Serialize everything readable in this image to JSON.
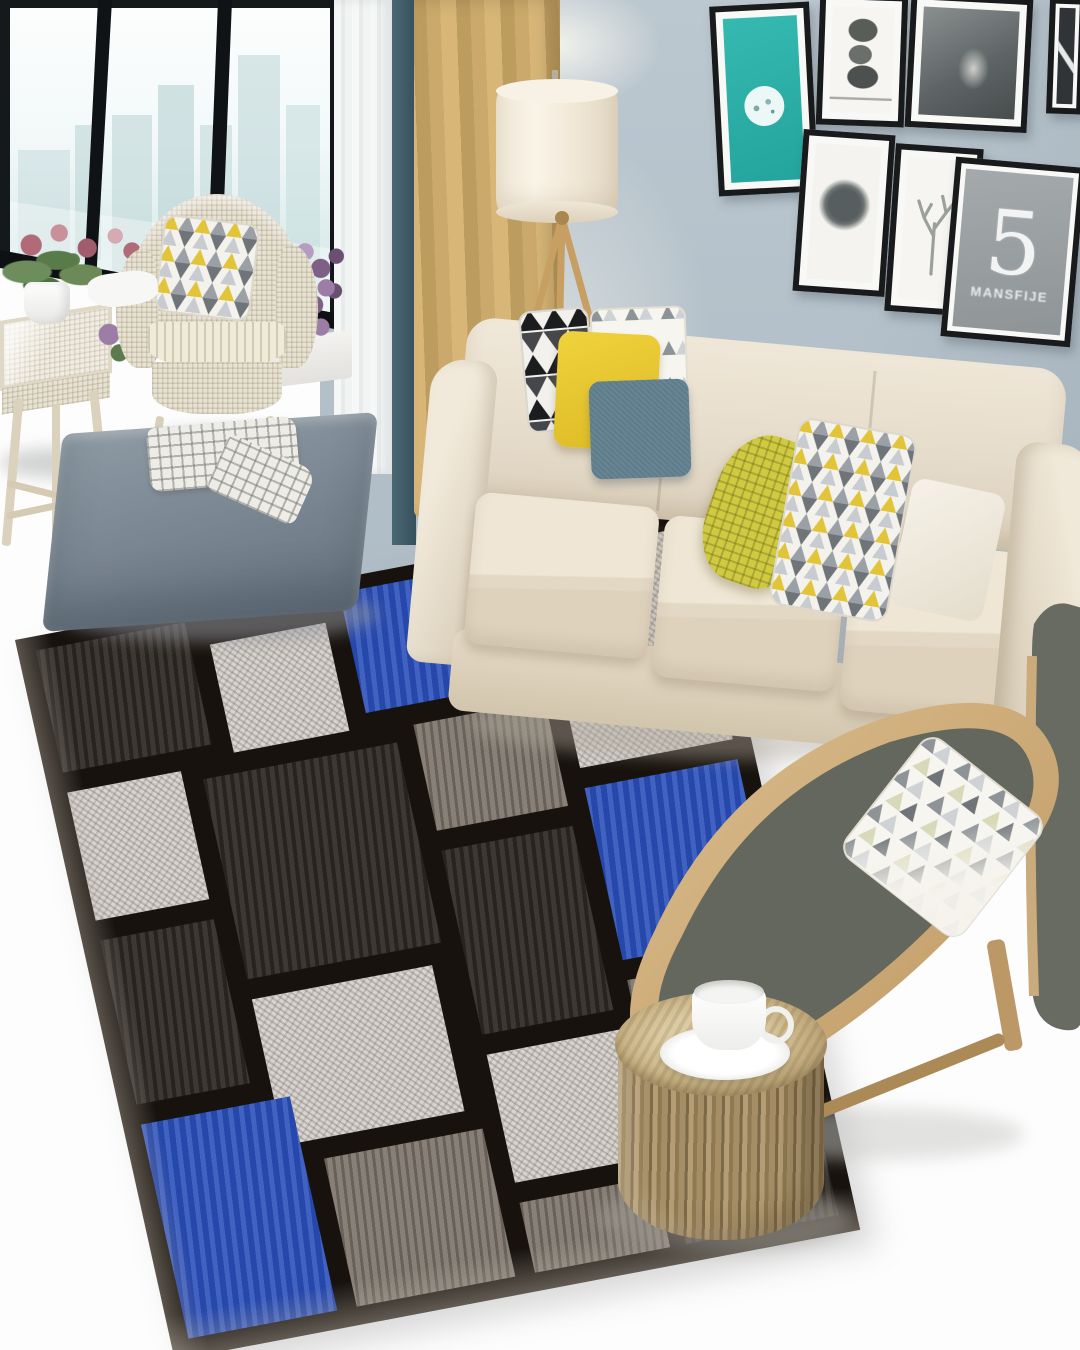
{
  "scene": {
    "type": "interior-photograph",
    "room": "living room",
    "style": "modern scandinavian",
    "floor_color": "#ffffff",
    "wall_color": "#b6c2ca"
  },
  "window": {
    "frame_color": "#14181b",
    "view": "city skyline",
    "skyline_color": "#c3d9da"
  },
  "curtains": {
    "sheer_color": "#f2f3f3",
    "gold_color": "#c5a468",
    "teal_color": "#41606c"
  },
  "floor_lamp": {
    "shade_color": "#f3ead9",
    "legs": "wood tripod"
  },
  "wall_art": {
    "teal_poster": {
      "bg_color": "#2eb2aa",
      "motif": "white circular illustration"
    },
    "stones_poster": {
      "motif": "stacked stones, black and white"
    },
    "figure_poster": {
      "motif": "black and white photograph"
    },
    "corner_poster": {
      "motif": "black and white photograph"
    },
    "moon_poster": {
      "motif": "dark mottled circle"
    },
    "deer_poster": {
      "motif": "antler line sketch"
    },
    "number_poster": {
      "bg_color": "#9aa0a2",
      "number": "5",
      "caption": "MANSFIJE"
    }
  },
  "sofa": {
    "color": "#e8e0cf",
    "seats": 3
  },
  "sofa_pillows": [
    {
      "name": "black-white-triangle",
      "colors": [
        "#1b1c1e",
        "#f2f1ed"
      ]
    },
    {
      "name": "yellow",
      "color": "#e9c92e"
    },
    {
      "name": "white",
      "color": "#f4f0e6"
    },
    {
      "name": "blue-gray",
      "color": "#5e7c8b"
    },
    {
      "name": "chartreuse-waffle",
      "color": "#d0ca43"
    },
    {
      "name": "yellow-gray-triangles",
      "colors": [
        "#e2c438",
        "#9aa0a6",
        "#f4f2ec"
      ]
    },
    {
      "name": "white-side",
      "color": "#f3efe5"
    }
  ],
  "ottoman": {
    "color": "#7d8a96",
    "blanket": "gray plaid throw"
  },
  "rug": {
    "style": "geometric patchwork",
    "colors": {
      "blue": "#2b50ba",
      "light": "#d8d4d0",
      "dark": "#38332e",
      "gray": "#7e766d",
      "lines": "#17120d"
    }
  },
  "lounge_chair": {
    "frame": "bent plywood",
    "cushion_color": "#64675d",
    "pillow": "white with gray and yellow triangles"
  },
  "stump_table": {
    "material": "tree trunk",
    "item": "white coffee cup and saucer"
  },
  "wicker_set": {
    "chair": "wicker armchair with triangle pillow",
    "table": "wicker side table",
    "plants": [
      "pink flowers",
      "green potted plant",
      "purple flowers"
    ]
  }
}
